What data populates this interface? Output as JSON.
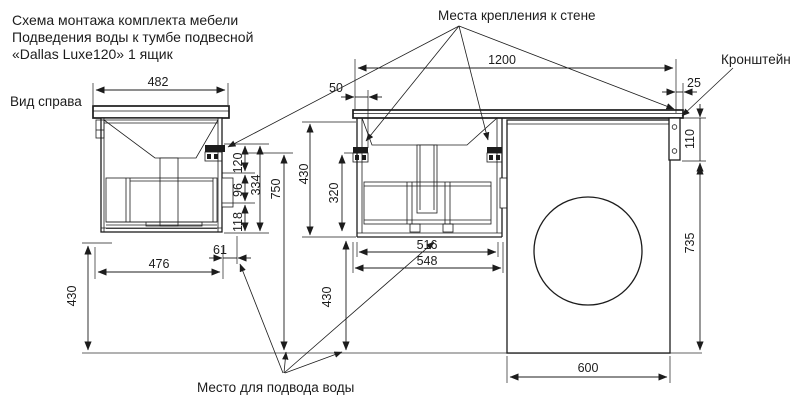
{
  "title": {
    "line1": "Схема монтажа комплекта мебели",
    "line2": "Подведения воды к тумбе подвесной",
    "line3": "«Dallas Luxe120» 1 ящик"
  },
  "labels": {
    "view_right": "Вид справа",
    "wall_mount_points": "Места крепления к стене",
    "bracket": "Кронштейн",
    "water_supply_place": "Место для подвода воды"
  },
  "dimensions": {
    "side_top_width": "482",
    "countertop_length": "1200",
    "mount_offset_left": "50",
    "mount_offset_right": "25",
    "bracket_height": "110",
    "machine_side_height": "735",
    "machine_width": "600",
    "side_bottom_width": "476",
    "water_point_offset": "61",
    "floor_clearance_side": "430",
    "seg_120": "120",
    "seg_96": "96",
    "seg_118": "118",
    "seg_total_334": "334",
    "total_height_750": "750",
    "front_drop_430": "430",
    "cabinet_height_320": "320",
    "floor_clearance_front": "430",
    "drawer_width_516": "516",
    "cabinet_width_548": "548"
  },
  "colors": {
    "line": "#1c1c1c",
    "floor": "#979797",
    "background": "#ffffff"
  }
}
